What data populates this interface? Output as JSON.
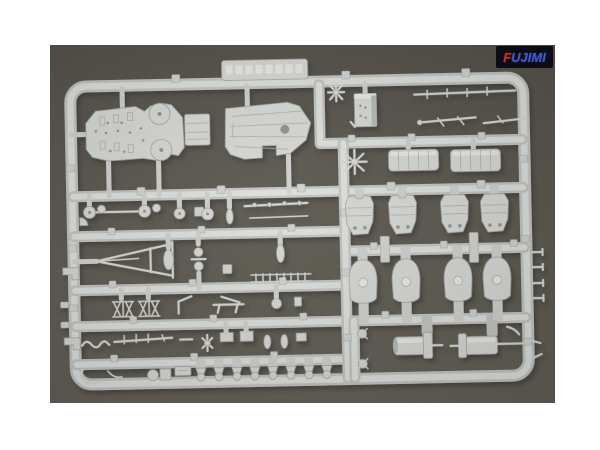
{
  "page": {
    "background": "#ffffff"
  },
  "photo": {
    "description": "Light gray injection-molded plastic model kit sprue (warship parts runner) photographed on a dark olive-gray background",
    "background_top": "#4f4c44",
    "background_bottom": "#5e5b51",
    "plastic_color": "#d7d9d5",
    "plastic_highlight": "#e9ebe7",
    "plastic_shadow": "#9ea09c",
    "logo": {
      "text": "FUJIMI",
      "background": "#0c0c12",
      "blue": "#3a57d0",
      "red": "#d8291b"
    },
    "parts": [
      {
        "name": "superstructure-deck",
        "count": 1
      },
      {
        "name": "forecastle-deck",
        "count": 1
      },
      {
        "name": "bridge-block",
        "count": 1
      },
      {
        "name": "deckhouse-block",
        "count": 2
      },
      {
        "name": "gun-turret",
        "count": 4
      },
      {
        "name": "turret-base",
        "count": 4
      },
      {
        "name": "funnel-drum",
        "count": 2
      },
      {
        "name": "tripod-mast",
        "count": 1
      },
      {
        "name": "searchlight",
        "count": 4
      },
      {
        "name": "yardarm-rod",
        "count": 3
      },
      {
        "name": "railing-stanchion",
        "count": 2
      },
      {
        "name": "pedestal-fitting",
        "count": 8
      },
      {
        "name": "propeller",
        "count": 3
      },
      {
        "name": "molded-label-tab",
        "count": 1
      }
    ]
  }
}
